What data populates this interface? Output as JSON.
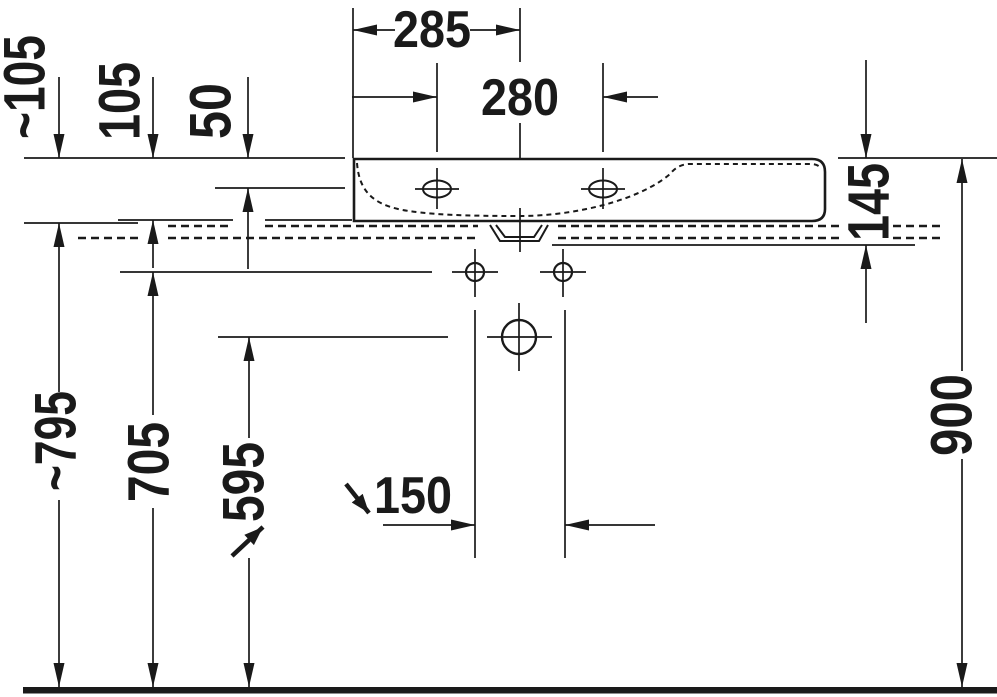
{
  "drawing": {
    "type": "installation technical drawing",
    "subject": "wall-mounted washbasin, front elevation with mounting dimensions",
    "units": "mm",
    "labels": {
      "edge_to_drain": "285",
      "tap_hole_spacing": "280",
      "approx_rim_offset": "~105",
      "rim_offset": "105",
      "rim_to_inner_edge": "50",
      "body_height": "145",
      "approx_floor_to_line": "~795",
      "floor_to_fixing_line": "705",
      "floor_to_drain": "595",
      "fixing_hole_spacing": "150",
      "floor_to_rim": "900"
    }
  }
}
